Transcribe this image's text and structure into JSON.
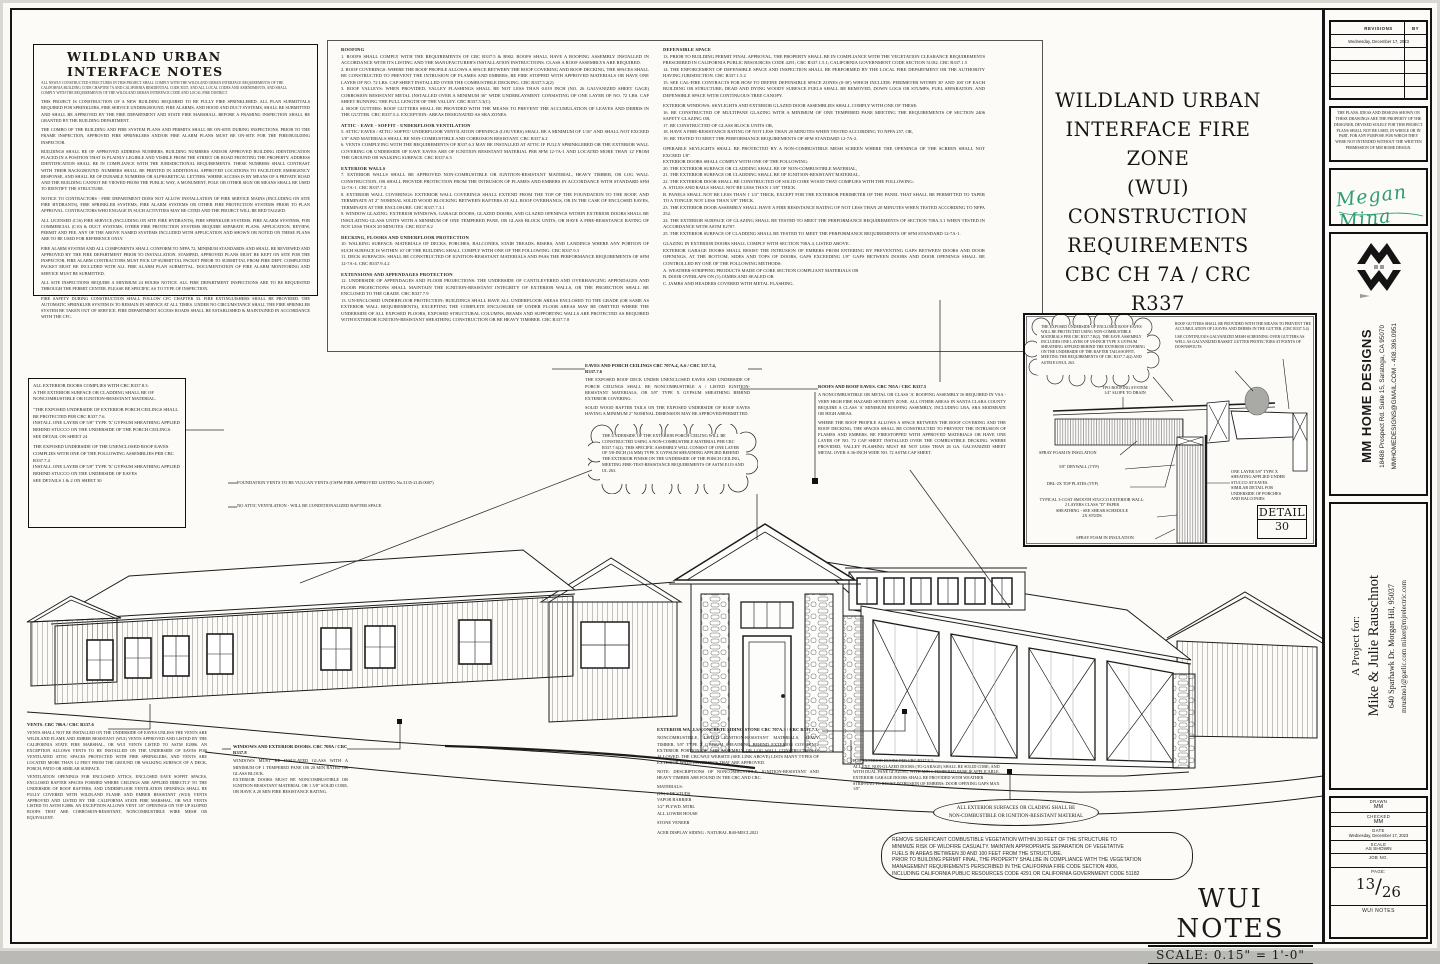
{
  "notes_box": {
    "title": "WILDLAND URBAN INTERFACE NOTES",
    "subtitle": "ALL NEWLY CONSTRUCTED STRUCTURES IN THIS PROJECT SHALL COMPLY WITH THE WILDLAND URBAN INTERFACE REQUIREMENTS OF THE CALIFORNIA BUILDING CODE CHAPTER 7A AND CALIFORNIA RESIDENTIAL CODE R337, AND ALL LOCAL CODES AND AMENDMENTS, AND SHALL COMPLY WITH THE REQUIREMENTS OF THE WILDLAND URBAN INTERFACE CODE AND LOCAL FIRE DISTRICT.",
    "paragraphs": [
      "THIS PROJECT IS CONSTRUCTION OF A NEW BUILDING REQUIRED TO BE FULLY FIRE SPRINKLERED. ALL PLAN SUBMITTALS REQUIRED FOR SPRINKLERS, FIRE SERVICE UNDERGROUND, FIRE ALARMS, AND HOOD AND DUCT SYSTEMS, SHALL BE SUBMITTED AND SHALL BE APPROVED BY THE FIRE DEPARTMENT AND STATE FIRE MARSHALL BEFORE A FRAMING INSPECTION SHALL BE GRANTED BY THE BUILDING DEPARTMENT.",
      "THE COMBO OF THE BUILDING AND FIRE SYSTEM PLANS AND PERMITS SHALL BE ON-SITE DURING INSPECTIONS. PRIOR TO THE FRAME INSPECTION, APPROVED FIRE SPRINKLERS AND/OR FIRE ALARM PLANS MUST BE ON-SITE FOR THE FIRE/BUILDING INSPECTOR.",
      "BUILDINGS SHALL BE OF APPROVED ADDRESS NUMBERS, BUILDING NUMBERS AND/OR APPROVED BUILDING IDENTIFICATION PLACED IN A POSITION THAT IS PLAINLY LEGIBLE AND VISIBLE FROM THE STREET OR ROAD FRONTING THE PROPERTY. ADDRESS IDENTIFICATION SHALL BE IN COMPLIANCE WITH THE JURISDICTIONAL REQUIREMENTS. THESE NUMBERS SHALL CONTRAST WITH THEIR BACKGROUND. NUMBERS SHALL BE PRINTED IN ADDITIONAL APPROVED LOCATIONS TO FACILITATE EMERGENCY RESPONSE, AND SHALL BE OF DURABLE NUMBERS OR ALPHABETICAL LETTERS. WHERE ACCESS IS BY MEANS OF A PRIVATE ROAD AND THE BUILDING CANNOT BE VIEWED FROM THE PUBLIC WAY, A MONUMENT, POLE OR OTHER SIGN OR MEANS SHALL BE USED TO IDENTIFY THE STRUCTURE.",
      "NOTICE TO CONTRACTORS - FIRE DEPARTMENT DOES NOT ALLOW INSTALLATION OF FIRE SERVICE MAINS (INCLUDING ON SITE FIRE HYDRANTS), FIRE SPRINKLER SYSTEMS, FIRE ALARM SYSTEMS OR OTHER FIRE PROTECTION SYSTEMS PRIOR TO PLAN APPROVAL. CONTRACTORS WHO ENGAGE IN SUCH ACTIVITIES MAY BE CITED AND THE PROJECT WILL BE RED TAGGED.",
      "ALL LICENSED (C16) FIRE SERVICE (INCLUDING ON SITE FIRE HYDRANTS), FIRE SPRINKLER SYSTEMS, FIRE ALARM SYSTEMS, FOR COMMERCIAL (C10) & DUCT SYSTEMS, OTHER FIRE PROTECTION SYSTEMS REQUIRE SEPARATE PLANS, APPLICATION, REVIEW, PERMIT AND FEE. ANY OF THE ABOVE NAMED SYSTEMS INCLUDED WITH APPLICATION AND SHOWN OR NOTED ON THESE PLANS ARE TO BE USED FOR REFERENCE ONLY.",
      "FIRE ALARM SYSTEM AND ALL COMPONENTS SHALL CONFORM TO NFPA 72, MINIMUM STANDARDS AND SHALL BE REVIEWED AND APPROVED BY THE FIRE DEPARTMENT PRIOR TO INSTALLATION. STAMPED, APPROVED PLANS MUST BE KEPT ON SITE FOR THE INSPECTOR. FIRE ALARM CONTRACTORS MUST PICK UP SUBMITTAL PACKET PRIOR TO SUBMITTAL FROM FIRE DEPT. COMPLETED PACKET MUST BE INCLUDED WITH ALL FIRE ALARM PLAN SUBMITTAL. DOCUMENTATION OF FIRE ALARM MONITORING AND SERVICE MUST BE SUBMITTED.",
      "ALL SITE INSPECTIONS REQUIRE A MINIMUM 24 HOURS NOTICE. ALL FIRE DEPARTMENT INSPECTIONS ARE TO BE REQUESTED THROUGH THE PERMIT CENTER. PLEASE BE SPECIFIC AS TO TYPE OF INSPECTION.",
      "FIRE SAFETY DURING CONSTRUCTION SHALL FOLLOW CFC CHAPTER 33. FIRE EXTINGUISHERS SHALL BE PROVIDED. THE AUTOMATIC SPRINKLER SYSTEM IS TO REMAIN IN SERVICE AT ALL TIMES. UNDER NO CIRCUMSTANCE SHALL THE FIRE SPRINKLER SYSTEM BE TAKEN OUT OF SERVICE. FIRE DEPARTMENT ACCESS ROADS SHALL BE ESTABLISHED & MAINTAINED IN ACCORDANCE WITH THE CFC."
    ]
  },
  "center_notes": {
    "col1": [
      {
        "h": "ROOFING",
        "b": "1. ROOFS SHALL COMPLY WITH THE REQUIREMENTS OF CBC R337.5 & R902. ROOFS SHALL HAVE A ROOFING ASSEMBLY INSTALLED IN ACCORDANCE WITH ITS LISTING AND THE MANUFACTURER'S INSTALLATION INSTRUCTIONS. CLASS A ROOF ASSEMBLYS ARE REQUIRED.\n2. ROOF COVERINGS: WHERE THE ROOF PROFILE ALLOWS A SPACE BETWEEN THE ROOF COVERING AND ROOF DECKING, THE SPACES SHALL BE CONSTRUCTED TO PREVENT THE INTRUSION OF FLAMES AND EMBERS, BE FIRE STOPPED WITH APPROVED MATERIALS OR HAVE ONE LAYER OF NO. 72 LBS. CAP SHEET INSTALLED OVER THE COMBUSTIBLE DECKING. CBC R337.5.2(2)\n3. ROOF VALLEYS: WHEN PROVIDED, VALLEY FLASHINGS SHALL BE NOT LESS THAN 0.019 INCH (NO. 26 GALVANIZED SHEET GAGE) CORROSION RESISTANT METAL INSTALLED OVER A MINIMUM 36\" WIDE UNDERLAYMENT CONSISTING OF ONE LAYER OF NO. 72 LBS. CAP SHEET RUNNING THE FULL LENGTH OF THE VALLEY. CBC R337.5.3(C)\n4. ROOF GUTTERS: ROOF GUTTERS SHALL BE PROVIDED WITH THE MEANS TO PREVENT THE ACCUMULATION OF LEAVES AND DEBRIS IN THE GUTTER. CBC R337.5.4. EXCEPTION: AREAS DESIGNATED AS SRA ZONES."
      },
      {
        "h": "ATTIC - EAVE - SOFFIT - UNDERFLOOR VENTILATION",
        "b": "5. ATTIC/ EAVES / ATTIC/ SOFFIT/ UNDERFLOOR VENTILATION OPENINGS (LOUVERS) SHALL BE A MINIMUM OF 1/16\" AND SHALL NOT EXCEED 1/8\" AND MATERIALS SHALL BE NON-COMBUSTIBLE AND CORROSION RESISTANT. CBC R337.6.2\n6. VENTS COMPLYING WITH THE REQUIREMENTS OF R337.6.3 MAY BE INSTALLED AT ATTIC IF FULLY SPRINKLERED OR THE EXTERIOR WALL COVERING OR UNDERSIDE OF EAVE EAVES ARE OF IGNITION RESISTANT MATERIAL PER SFM 12-7A-1 AND LOCATED MORE THAN 12' FROM THE GROUND OR WALKING SURFACE. CBC R337.6.3"
      },
      {
        "h": "EXTERIOR WALLS",
        "b": "7. EXTERIOR WALLS SHALL BE APPROVED NON-COMBUSTIBLE OR IGNITION-RESISTANT MATERIAL, HEAVY TIMBER, OR LOG WALL CONSTRUCTION, OR SHALL PROVIDE PROTECTION FROM THE INTRUSION OF FLAMES AND EMBERS IN ACCORDANCE WITH STANDARD SFM 12-7A-1. CBC R337.7.3\n8. EXTERIOR WALL COVERINGS: EXTERIOR WALL COVERINGS SHALL EXTEND FROM THE TOP OF THE FOUNDATION TO THE ROOF, AND TERMINATE AT 2\" NOMINAL SOLID WOOD BLOCKING BETWEEN RAFTERS AT ALL ROOF OVERHANGS, OR IN THE CASE OF ENCLOSED EAVES, TERMINATE AT THE ENCLOSURE. CBC R337.7.3.1\n9. WINDOW GLAZING: EXTERIOR WINDOWS, GARAGE DOORS, GLAZED DOORS, AND GLAZED OPENINGS WITHIN EXTERIOR DOORS SHALL BE INSULATING-GLASS UNITS WITH A MINIMUM OF ONE TEMPERED PANE, OR GLASS BLOCK UNITS, OR HAVE A FIRE-RESISTANCE RATING OF NOT LESS THAN 20 MINUTES. CBC R337.8.2"
      },
      {
        "h": "DECKING, FLOORS AND UNDERFLOOR PROTECTION",
        "b": "10. WALKING SURFACE: MATERIALS OF DECKS, PORCHES, BALCONIES, STAIR TREADS, RISERS, AND LANDINGS WHERE ANY PORTION OF SUCH SURFACE IS WITHIN 10' OF THE BUILDING SHALL COMPLY WITH ONE OF THE FOLLOWING: CBC R337.9.3\n11. DECK SURFACES: SHALL BE CONSTRUCTED OF IGNITION-RESISTANT MATERIALS AND PASS THE PERFORMANCE REQUIREMENTS OF SFM 12-7A-4. CBC R337.9.4.2"
      },
      {
        "h": "EXTENSIONS AND APPENDAGES PROTECTION",
        "b": "12. UNDERSIDE OF APPENDAGES AND FLOOR PROJECTIONS: THE UNDERSIDE OF CANTILEVERED AND OVERHANGING APPENDAGES AND FLOOR PROJECTIONS SHALL MAINTAIN THE IGNITION-RESISTANT INTEGRITY OF EXTERIOR WALLS, OR THE PROJECTION SHALL BE ENCLOSED TO THE GRADE. CBC R337.7.9\n13. UN-ENCLOSED UNDERFLOOR PROTECTION: BUILDINGS SHALL HAVE ALL UNDERFLOOR AREAS ENCLOSED TO THE GRADE (OR SAME AS EXTERIOR WALL REQUIREMENTS), EXCEPTING THE COMPLETE ENCLOSURE OF UNDER FLOOR AREAS MAY BE OMITTED WHERE THE UNDERSIDE OF ALL EXPOSED FLOORS, EXPOSED STRUCTURAL COLUMNS, BEAMS AND SUPPORTING WALLS ARE PROTECTED AS REQUIRED WITH EXTERIOR IGNITION-RESISTANT SHEATHING CONSTRUCTION OR BE HEAVY TIM0BER. CBC R337.7.8"
      }
    ],
    "col2": [
      {
        "h": "DEFENSIBLE SPACE",
        "b": "13. PRIOR TO BUILDING PERMIT FINAL APPROVAL, THE PROPERTY SHALL BE IN COMPLIANCE WITH THE VEGETATION CLEARANCE REQUIREMENTS PRESCRIBED IN CALIFORNIA PUBLIC RESOURCES CODE 4291; CBC R337.1.5.1; CALIFORNIA GOVERNMENT CODE SECTION 51182. CBC R337.1.5\n14. THE ENFORCEMENT OF DEFENSIBLE SPACE AND INSPECTION SHALL BE PERFORMED BY THE LOCAL FIRE DEPARTMENT OR THE AUTHORITY HAVING JURISDICTION. CBC R337.1.5.2\n15. SEE CAL-FIRE CONTRACTS FOR HOW TO DEFINE DEFENSIBLE SPACE ZONES (0-30') WHICH INCLUDE: PERIMETER WITHIN 30' AND 100' OF EACH BUILDING OR STRUCTURE; DEAD AND DYING WOODY SURFACE FUELS SHALL BE REMOVED, DOWN LOGS OR STUMPS, FUEL SEPARATION, AND DEFENSIBLE SPACE WITH CONTINUOUS TREE CANOPY."
      },
      {
        "h": "",
        "b": "EXTERIOR WINDOWS, SKYLIGHTS AND EXTERIOR GLAZED DOOR ASSEMBLIES SHALL COMPLY WITH ONE OF THESE:\n16. BE CONSTRUCTED OF MULTIPANE GLAZING WITH A MINIMUM OF ONE TEMPERED PANE MEETING THE REQUIREMENTS OF SECTION 2406 SAFETY GLAZING OR,\n17. BE CONSTRUCTED OF GLASS BLOCK UNITS OR,\n18. HAVE A FIRE-RESISTANCE RATING OF NOT LESS THAN 20 MINUTES WHEN TESTED ACCORDING TO NFPA 257, OR,\n19. BE TESTED TO MEET THE PERFORMANCE REQUIREMENTS OF SFM STANDARD 12-7A-2."
      },
      {
        "h": "",
        "b": "OPERABLE SKYLIGHTS SHALL BE PROTECTED BY A NON-COMBUSTIBLE MESH SCREEN WHERE THE OPENINGS OF THE SCREEN SHALL NOT EXCEED 1/8\".\nEXTERIOR DOORS SHALL COMPLY WITH ONE OF THE FOLLOWING:\n20. THE EXTERIOR SURFACE OR CLADDING SHALL BE OF NON-COMBUSTIBLE MATERIAL,\n21. THE EXTERIOR SURFACE OR CLADDING SHALL BE OF IGNITION-RESISTANT MATERIAL,\n22. THE EXTERIOR DOOR SHALL BE CONSTRUCTED OF SOLID CORE WOOD THAT COMPLIES WITH THE FOLLOWING:\nA. STILES AND RAILS SHALL NOT BE LESS THAN 1 3/8\" THICK.\nB. PANELS SHALL NOT BE LESS THAN 1 1/4\" THICK, EXCEPT FOR THE EXTERIOR PERIMETER OF THE PANEL THAT SHALL BE PERMITTED TO TAPER TO A TONGUE NOT LESS THAN 3/8\" THICK.\n23. THE EXTERIOR DOOR ASSEMBLY SHALL HAVE A FIRE RESISTANCE RATING OF NOT LESS THAN 20 MINUTES WHEN TESTED ACCORDING TO NFPA 252.\n24. THE EXTERIOR SURFACE OF GLAZING SHALL BE TESTED TO MEET THE PERFORMANCE REQUIREMENTS OF SECTION 708A.3.1 WHEN TESTED IN ACCORDANCE WITH ASTM E2707.\n25. THE EXTERIOR SURFACE OF CLADDING SHALL BE TESTED TO MEET THE PERFORMANCE REQUIREMENTS OF SFM STANDARD 12-7A-1."
      },
      {
        "h": "",
        "b": "GLAZING IN EXTERIOR DOORS SHALL COMPLY WITH SECTION 708A.4, LISTED ABOVE.\nEXTERIOR GARAGE DOORS SHALL RESIST THE INTRUSION OF EMBERS FROM ENTERING BY PREVENTING GAPS BETWEEN DOORS AND DOOR OPENINGS. AT THE BOTTOM, SIDES AND TOPS OF DOORS, GAPS EXCEEDING 1/8\" GAPS BETWEEN DOORS AND DOOR OPENINGS SHALL BE CONTROLLED BY ONE OF THE FOLLOWING METHODS:\nA. WEATHER-STRIPPING PRODUCTS MADE OF CORE SECTION COMPLIANT MATERIALS OR\nB. DOOR OVERLAPS ON (1) JAMBS AND SEALED OR\nC. JAMBS AND HEADERS COVERED WITH METAL FLASHING."
      }
    ]
  },
  "main_title": {
    "l1": "WILDLAND URBAN",
    "l2": "INTERFACE FIRE ZONE",
    "l3": "(WUI)",
    "l4": "CONSTRUCTION",
    "l5": "REQUIREMENTS",
    "l6": "CBC CH 7A / CRC R337"
  },
  "box2": {
    "p1": "ALL EXTERIOR DOORS COMPLIES WITH  CBC R337.8.3.\nA THE EXTERIOR SURFACE OR CLADDING SHALL BE OF NONCOMBUSTIBLE OR IGNITION-RESISTANT MATERIAL.",
    "p2": "\"THE EXPOSED UNDERSIDE OF EXTERIOR PORCH CEILINGS SHALL BE PROTECTED PER CBC R337.7.6.\nINSTALL ONE LAYER OF 5/8\" TYPE 'X' GYPSUM SHEATHING APPLIED BEHIND STUCCO ON THE UNDERSIDE OF THE PORCH CEILINGS.\nSEE DETAIL ON SHEET 24",
    "p3": "THE EXPOSED UNDERSIDE OF THE UNENCLOSED ROOF EAVES COMPLIES WITH ONE OF THE FOLLOWING ASSEMBLIES PER CBC R337.7.4\nINSTALL ONE LAYER OF 5/8\" TYPE 'X' GYPSUM SHEATHING APPLIED BEHIND STUCCO ON THE UNDERSIDE OF EAVES\nSEE DETAILS 1 & 2 ON SHEET 30"
  },
  "callouts": {
    "eaves_h": "EAVES AND PORCH CEILINGS   CBC 707A.4, A.6 / CRC 337.7.4,\nR337.7.6",
    "eaves_p1": "THE EXPOSED ROOF DECK UNDER UNENCLOSED EAVES AND UNDERSIDE OF PORCH CEILINGS SHALL BE NONCOMBUSTIBLE A / LISTED IGNITION-RESISTANT MATERIALS, OR 5/8\" TYPE X GYPSUM SHEATHING BEHIND EXTERIOR COVERING.",
    "eaves_p2": "SOLID WOOD RAFTER TAILS ON THE EXPOSED UNDERSIDE OF ROOF EAVES HAVING A MINIMUM 2\" NOMINAL DIMENSION MAY BE APPROVED/PERMITTED.",
    "cloud_porch": "THE UNDERSIDE OF THE EXTERIOR PORCH CEILING WILL BE CONSTRUCTED USING A NON-COMBUSTIBLE MATERIAL PER CRC R337.7.6(2). THIS SPECIFIC ASSEMBLY WILL CONSIST OF ONE LAYER OF 5/8-INCH (16 MM) TYPE X GYPSUM SHEATHING APPLIED BEHIND THE EXTERIOR FINISH ON THE UNDERSIDE OF THE PORCH CEILING, MEETING FIRE-TEST-RESISTANCE REQUIREMENTS OF ASTM E119 AND UL 263.",
    "roofs_h": "ROOFS AND ROOF EAVES.   CBC 705A / CRC R337.5",
    "roofs_p1": "A NONCOMBUSTIBLE OR METAL OR CLASS 'A' ROOFING ASSEMBLY IS REQUIRED IN VSA - VERY HIGH FIRE HAZARD SEVERITY ZONE. ALL OTHER AREAS IN SANTA CLARA COUNTY REQUIRE A CLASS 'A' MINIMUM ROOFING ASSEMBLY, INCLUDING LRA, SRA MODERATE OR HIGH AREAS.",
    "roofs_p2": "WHERE THE ROOF PROFILE ALLOWS A SPACE BETWEEN THE ROOF COVERING AND THE ROOF DECKING, THE SPACES SHALL BE CONSTRUCTED TO PREVENT THE INTRUSION OF FLAMES AND EMBERS, BE FIRESTOPPED WITH APPROVED MATERIALS OR HAVE ONE LAYER OF NO. 72 CAP SHEET INSTALLED OVER THE COMBUSTIBLE DECKING. WHERE PROVIDED, VALLEY FLASHING MUST BE NOT LESS THAN 26 GA. GALVANIZED SHEET METAL OVER A 36-INCH WIDE NO. 72 ASTM CAP SHEET.",
    "vulcan1": "FOUNDATION VENTS TO BE VULCAN VENTS (CSFM FIRE APPROVED LISTING No.3135-2145:0007)",
    "vulcan2": "NO ATTIC VENTILATION - WILL BE CONDITIONALIZED RAFTER SPACE",
    "windows_h": "WINDOWS AND EXTERIOR DOORS.  CBC 708A / CRC\nR337.8",
    "windows_b": "WINDOWS MUST BE INSULATED GLASS WITH A MINIMUM OF 1 TEMPERED PANE OR 20 MIN RATED OR GLASS BLOCK.\nEXTERIOR DOORS MUST BE NONCOMBUSTIBLE OR IGNITION RESISTANT MATERIAL OR 1 3/8\" SOLID CORE, OR HAVE A 20 MIN FIRE RESISTANCE RATING.",
    "extwalls_h": "EXTERIOR WALLS/CONCRETE SIDING STONE   CBC 707A.3 / CRC R337.7.3",
    "extwalls_p": "NONCOMBUSTIBLE, LISTED IGNITION-RESISTANT MATERIALS, HEAVY TIMBER, 5/8\" TYPE X GYPSUM SHEATHING BEHIND EXTERIOR COVERING, EXTERIOR PORTION OF 1-HR ASSEMBLY OR LOG WALL CONSTRUCTION IS ALLOWED. THE CBC/WUI WEBSITE (SEE LINK ABOVE) LISTS MANY TYPES OF EXTERIOR WALL COVERINGS THAT ARE APPROVED.",
    "extwalls_note": "NOTE:  DESCRIPTIONS OF NONCOMBUSTIBLE, IGNITION-RESISTANT AND HEAVY TIMBER ARE FOUND IN THE CBC AND CRC.",
    "materials": "MATERIALS:\n(2X) 2 DF STUDS\nVAPOR BARRIER\n1/2\" PLYWD. MTRL\nALL LOWER HOUSE",
    "stone": "STONE VENEER",
    "siding_line": "ACER DISPLAY SIDING : NATURAL R40-MECL2021",
    "garage_note": "FOR EXTERIOR DOORS PER CBC R337.8.3:\nALL EXT. NON-GLAZED DOORS (TO GARAGE) SHALL BE SOLID CORE; AND WITH DUAL PANE GLAZING, WITH MIN 1 TEMPERED PANE IF APPLICABLE. EXTERIOR GARAGE DOORS SHALL BE PROVIDED WITH WEATHER STRIPPING TO RESIST INTRUSION OF EMBERS; DOOR OPENING GAPS MAX 1/8\".",
    "oval": "ALL EXTERIOR SURFACES OR CLADING SHALL BE\nNON-COMBUSTIBLE OR IGNITION-RESISTANT MATERIAL",
    "veg": "REMOVE SIGNIFICANT COMBUSTIBLE VEGETATION WITHIN 30 FEET OF THE STRUCTURE TO\nMINIMIZE RISK OF WILDFIRE CASUALTY. MAINTAIN APPROPRIATE SEPARATION OF VEGETATIVE\nFUELS IN AREAS BETWEEN 30 AND 100 FEET FROM THE STRUCTURE.\nPRIOR TO BUILDING PERMIT FINAL, THE PROPERTY SHALLBE IN COMPLIANCE WITH THE VEGETATION\nMANAGEMENT REQUIREMENTS PERSCRIBED IN THE CALIFORNIA FIRE CODE SECTION 4906,\nINCLUDING CALIFORNIA PUBLIC RESOURCES CODE 4291 OR CALIFORNIA GOVERNMENT CODE 51182",
    "bleft_h": "VENTS. CBC 706A / CRC R337.6",
    "bleft_p1": "VENTS SHALL NOT BE INSTALLED ON THE UNDERSIDE OF EAVES UNLESS THE VENTS ARE WILDLAND FLAME AND EMBER RESISTANT (WUI) VENTS APPROVED AND LISTED BY THE CALIFORNIA STATE FIRE MARSHAL, OR WUI VENTS LISTED TO ASTM E2886. AN EXCEPTION ALLOWS VENTS TO BE INSTALLED ON THE UNDERSIDE OF EAVES FOR VENTILATED ATTIC SPACES PROTECTED WITH FIRE SPRINKLERS, AND VENTS ARE LOCATED MORE THAN 12 FEET FROM THE GROUND OR WALKING SURFACE OF A DECK, PORCH, PATIO OR SIMILAR SURFACE.",
    "bleft_p2": "VENTILATION OPENINGS FOR ENCLOSED ATTICS, ENCLOSED EAVE SOFFIT SPACES, ENCLOSED RAFTER SPACES FORMED WHERE CEILINGS ARE APPLIED DIRECTLY TO THE UNDERSIDE OF ROOF RAFTERS, AND UNDERFLOOR VENTILATION OPENINGS SHALL BE FULLY COVERED WITH WILDLAND FLAME AND EMBER RESISTANT (WUI) VENTS APPROVED AND LISTED BY THE CALIFORNIA STATE FIRE MARSHAL, OR WUI VENTS LISTED TO ASTM E2886. AN EXCEPTION ALLOWS VENT 1/8\" OPENINGS ON TOP UP SLOPED ROOFS THAT ARE CORROSION-RESISTANT, NONCOMBUSTIBLE WIRE MESH OR EQUIVALENT."
  },
  "detail30": {
    "cloud": "THE EXPOSED UNDERSIDE OF ENCLOSED ROOF EAVES WILL BE PROTECTED USING NON-COMBUSTIBLE MATERIALS PER CBC R337.7.B(2). THE EAVE ASSEMBLY INCLUDES ONE LAYER OF 5/8-INCH TYPE X GYPSUM SHEATHING APPLIED BEHIND THE EXTERIOR COVERING ON THE UNDERSIDE OF THE RAFTER TAILS/SOFFIT, MEETING THE REQUIREMENTS OF CBC R337.7.4(2) AND ASTM E119/UL 263.",
    "note1": "ROOF GUTTERS SHALL BE PROVIDED WITH THE MEANS TO PREVENT THE ACCUMULATION OF LEAVES AND DEBRIS IN THE GUTTER. (CBC R337.5.4)",
    "note2": "USE CONTINUOUS GALVANIZED MESH SCREENING OVER GUTTERS AS WELL AS GALVANIZED BASKET GUTTER PROTECTORS AT POINTS OF DOWNSPOUTS",
    "tpo": "TPO ROOFING SYSTEM\n1/4\" SLOPE TO DRAIN",
    "spray1": "SPRAY FOAM IN INSULATION",
    "drywall": "5/8\" DRYWALL (TYP)",
    "plates": "DBL-2X TOP PLATES (TYP)",
    "stucco": "TYPICAL 3-COAT SMOOTH STUCCO EXTERIOR WALL:\n2 LAYERS CLASS \"D\" PAPER\nSHEATHING - SEE SHEAR SCHEDULE\n2X STUDS",
    "spray2": "SPRAY FOAM IN INSULATION",
    "right_label": "ONE LAYER 5/8\" TYPE X\nSHEATING APPLIED UNDER\nSTUCCO AT EAVES.\nSIMILAR DETAIL FOR\nUNDERSIDE OF PORCHES\nAND BALCONIES",
    "title": "DETAIL",
    "number": "30"
  },
  "footer": {
    "title": "WUI NOTES",
    "scale": "SCALE: 0.15\" = 1'-0\""
  },
  "revisions": {
    "header_left": "REVISIONS",
    "header_right": "BY",
    "date_row": "Wednesday, December 17, 2023"
  },
  "copyright": "THE PLANS, IDEAS AND DESIGNS SHOWN ON THESE DRAWINGS ARE THE PROPERTY OF THE DESIGNER, DEVISED SOLELY FOR THIS PROJECT. PLANS SHALL NOT BE USED, IN WHOLE OR IN PART, FOR ANY PURPOSE FOR WHICH THEY WERE NOT INTENDED WITHOUT THE WRITTEN PERMISSION OF MM HOME DESIGN.",
  "signature": "Megan Mina",
  "brand": {
    "name": "MM HOME DESIGNS",
    "address": "18488 Prospect Rd. Suite 15, Saratoga, CA 95070",
    "contact": "MMHOMEDESIGNS@GMAIL.COM  -  408.396.0951"
  },
  "project": {
    "label": "A Project for:",
    "name": "Mike & Julie Rauschnot",
    "address": "640 Sparhawk Dr.    Morgan Hil, 95037",
    "emails": "mrushno1@garlic.com   miker@mjrelectric.com"
  },
  "titleblock": {
    "drawn_label": "DRAWN",
    "drawn": "MM",
    "checked_label": "CHECKED",
    "checked": "MM",
    "date_label": "DATE",
    "date": "Wednesday, December 17, 2023",
    "scale_label": "SCALE",
    "scale": "AS SHOWN",
    "job_label": "JOB NO.",
    "page_label": "PAGE:",
    "page_num": "13",
    "page_sep": "/",
    "page_total": "26",
    "sheet_name": "WUI NOTES"
  }
}
